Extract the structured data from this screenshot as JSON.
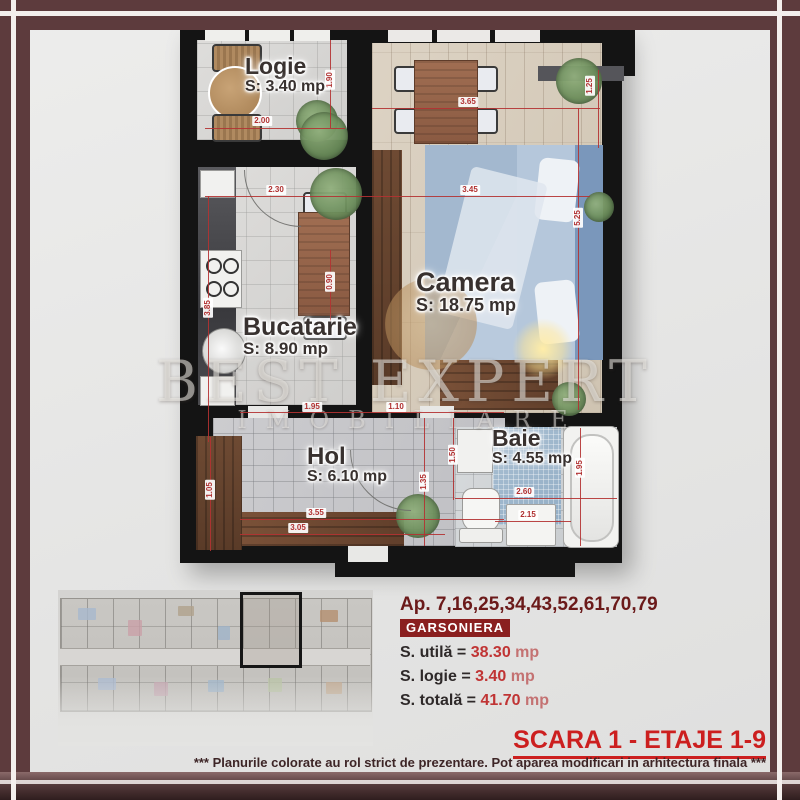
{
  "watermark": {
    "line1": "BEST EXPERT",
    "line2": "IMOBILIARE"
  },
  "plan": {
    "rooms": [
      {
        "id": "logie",
        "name": "Logie",
        "area": "S: 3.40 mp",
        "x": 245,
        "y": 54,
        "ns": 23,
        "as": 16
      },
      {
        "id": "camera",
        "name": "Camera",
        "area": "S: 18.75 mp",
        "x": 416,
        "y": 268,
        "ns": 27,
        "as": 18
      },
      {
        "id": "bucatarie",
        "name": "Bucatarie",
        "area": "S: 8.90 mp",
        "x": 243,
        "y": 314,
        "ns": 25,
        "as": 17
      },
      {
        "id": "hol",
        "name": "Hol",
        "area": "S: 6.10 mp",
        "x": 307,
        "y": 444,
        "ns": 24,
        "as": 16
      },
      {
        "id": "baie",
        "name": "Baie",
        "area": "S: 4.55 mp",
        "x": 492,
        "y": 426,
        "ns": 23,
        "as": 16
      }
    ],
    "dimensions": [
      {
        "t": "2.00",
        "x": 262,
        "y": 121,
        "r": 0
      },
      {
        "t": "1.90",
        "x": 330,
        "y": 80,
        "r": 1
      },
      {
        "t": "3.65",
        "x": 468,
        "y": 102,
        "r": 0
      },
      {
        "t": "2.30",
        "x": 276,
        "y": 190,
        "r": 0
      },
      {
        "t": "3.45",
        "x": 470,
        "y": 190,
        "r": 0
      },
      {
        "t": "5.25",
        "x": 578,
        "y": 218,
        "r": 1
      },
      {
        "t": "1.25",
        "x": 590,
        "y": 86,
        "r": 1
      },
      {
        "t": "3.85",
        "x": 208,
        "y": 308,
        "r": 1
      },
      {
        "t": "0.90",
        "x": 330,
        "y": 282,
        "r": 1
      },
      {
        "t": "1.95",
        "x": 312,
        "y": 407,
        "r": 0
      },
      {
        "t": "1.10",
        "x": 396,
        "y": 407,
        "r": 0
      },
      {
        "t": "3.55",
        "x": 316,
        "y": 513,
        "r": 0
      },
      {
        "t": "3.05",
        "x": 298,
        "y": 528,
        "r": 0
      },
      {
        "t": "1.35",
        "x": 424,
        "y": 482,
        "r": 1
      },
      {
        "t": "1.50",
        "x": 453,
        "y": 455,
        "r": 1
      },
      {
        "t": "1.05",
        "x": 210,
        "y": 490,
        "r": 1
      },
      {
        "t": "2.60",
        "x": 524,
        "y": 492,
        "r": 0
      },
      {
        "t": "2.15",
        "x": 528,
        "y": 515,
        "r": 0
      },
      {
        "t": "1.95",
        "x": 580,
        "y": 468,
        "r": 1
      }
    ],
    "lines": [
      {
        "x": 205,
        "y": 128,
        "w": 140,
        "h": 1
      },
      {
        "x": 372,
        "y": 108,
        "w": 228,
        "h": 1
      },
      {
        "x": 205,
        "y": 196,
        "w": 385,
        "h": 1
      },
      {
        "x": 240,
        "y": 412,
        "w": 264,
        "h": 1
      },
      {
        "x": 240,
        "y": 519,
        "w": 264,
        "h": 1
      },
      {
        "x": 240,
        "y": 534,
        "w": 205,
        "h": 1
      },
      {
        "x": 455,
        "y": 498,
        "w": 162,
        "h": 1
      },
      {
        "x": 495,
        "y": 521,
        "w": 76,
        "h": 1
      },
      {
        "x": 330,
        "y": 40,
        "w": 1,
        "h": 88
      },
      {
        "x": 578,
        "y": 108,
        "w": 1,
        "h": 302
      },
      {
        "x": 598,
        "y": 70,
        "w": 1,
        "h": 78
      },
      {
        "x": 208,
        "y": 196,
        "w": 1,
        "h": 246
      },
      {
        "x": 330,
        "y": 250,
        "w": 1,
        "h": 72
      },
      {
        "x": 424,
        "y": 418,
        "w": 1,
        "h": 128
      },
      {
        "x": 453,
        "y": 418,
        "w": 1,
        "h": 82
      },
      {
        "x": 210,
        "y": 437,
        "w": 1,
        "h": 114
      },
      {
        "x": 580,
        "y": 428,
        "w": 1,
        "h": 118
      }
    ]
  },
  "info_panel": {
    "apartments": "Ap. 7,16,25,34,43,52,61,70,79",
    "type": "GARSONIERA",
    "rows": [
      {
        "label": "S. utilă = ",
        "value": "38.30",
        "unit": " mp"
      },
      {
        "label": "S. logie = ",
        "value": "3.40",
        "unit": " mp"
      },
      {
        "label": "S. totală = ",
        "value": "41.70",
        "unit": " mp"
      }
    ]
  },
  "footer": {
    "scara": "SCARA 1 - ETAJE 1-9",
    "disclaimer": "*** Planurile colorate au rol strict de prezentare. Pot aparea modificari in arhitectura finala ***"
  },
  "colors": {
    "frame": "#5d3b3d",
    "walls": "#141414",
    "dimension_red": "#b43232",
    "accent_red": "#cc1f1f",
    "panel_red": "#8a1f1f",
    "value_red": "#c03434"
  }
}
